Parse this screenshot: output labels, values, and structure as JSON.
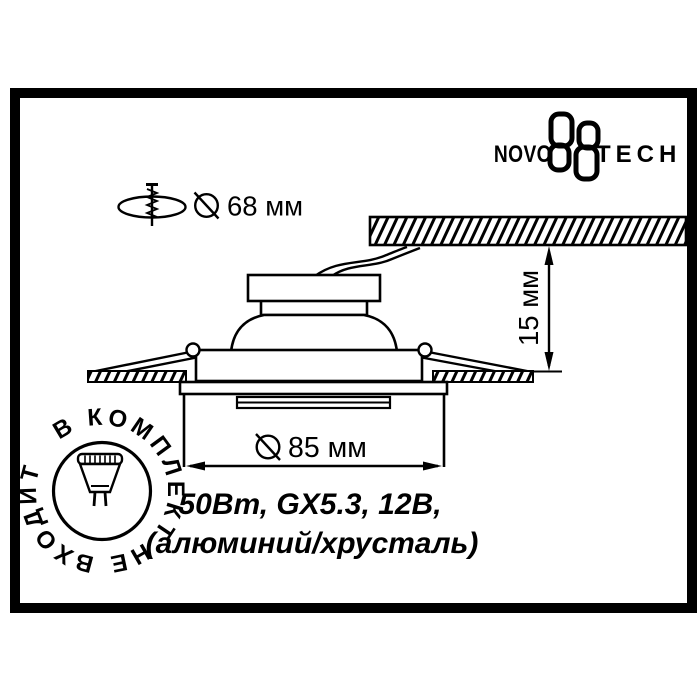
{
  "card": {
    "background": "#ffffff",
    "ink": "#000000"
  },
  "logo": {
    "left": "NOVO",
    "right": "TECH"
  },
  "annotations": {
    "cutout": {
      "label": "68 мм"
    },
    "height": {
      "label": "15 мм"
    },
    "diameter": {
      "label": "85 мм"
    }
  },
  "specs": {
    "line1": "50Вт, GX5.3, 12В,",
    "line2": "(алюминий/хрусталь)"
  },
  "stamp": {
    "text": "В КОМПЛЕКТ НЕ ВХОДИТ"
  }
}
